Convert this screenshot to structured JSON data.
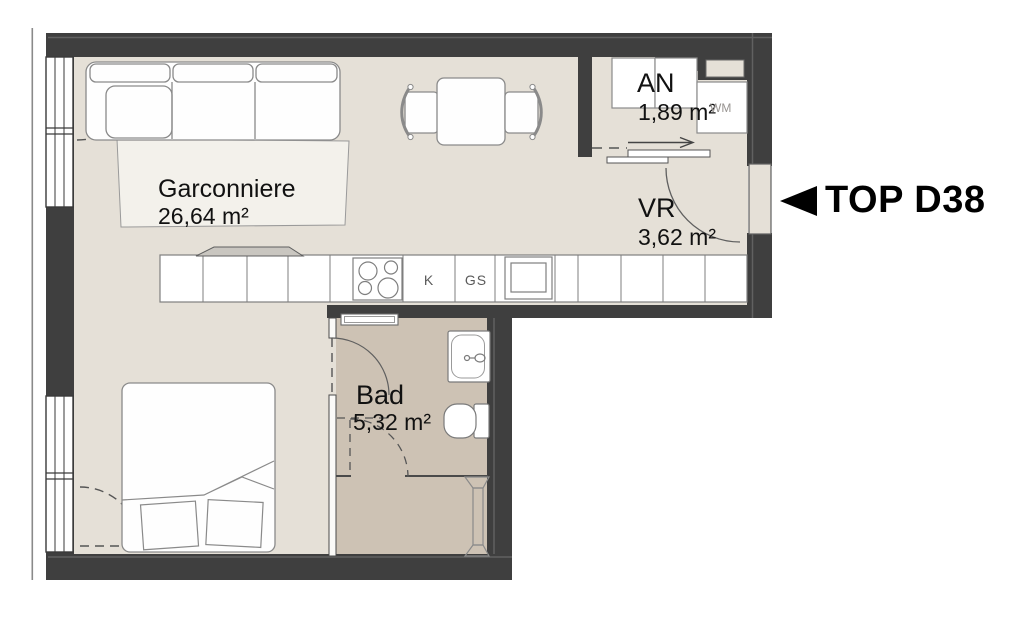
{
  "floorplan": {
    "unit": {
      "label": "TOP D38",
      "pointer_icon": "left-triangle"
    },
    "rooms": [
      {
        "name": "Garconniere",
        "area": "26,64 m²"
      },
      {
        "name": "AN",
        "area": "1,89 m²"
      },
      {
        "name": "VR",
        "area": "3,62 m²"
      },
      {
        "name": "Bad",
        "area": "5,32 m²"
      }
    ],
    "appliances": {
      "washing_machine": "WM",
      "fridge": "K",
      "dishwasher": "GS"
    },
    "fixtures": [
      "sofa",
      "rug",
      "dining-table",
      "dining-chairs",
      "kitchen-counter",
      "cooktop",
      "kitchen-sink",
      "radiator",
      "bed",
      "pillows",
      "washbasin",
      "toilet",
      "towel-radiator",
      "shower-drain",
      "entrance-door",
      "sliding-door",
      "windows",
      "wardrobe-row"
    ],
    "colors": {
      "wall": "#3f3f3f",
      "floor_main": "#e5e0d7",
      "floor_bath": "#cdc2b4",
      "rug": "#f3f1eb",
      "furniture_fill": "#fefefe",
      "furniture_stroke": "#888888",
      "text": "#111111",
      "unit_text": "#000000"
    }
  }
}
